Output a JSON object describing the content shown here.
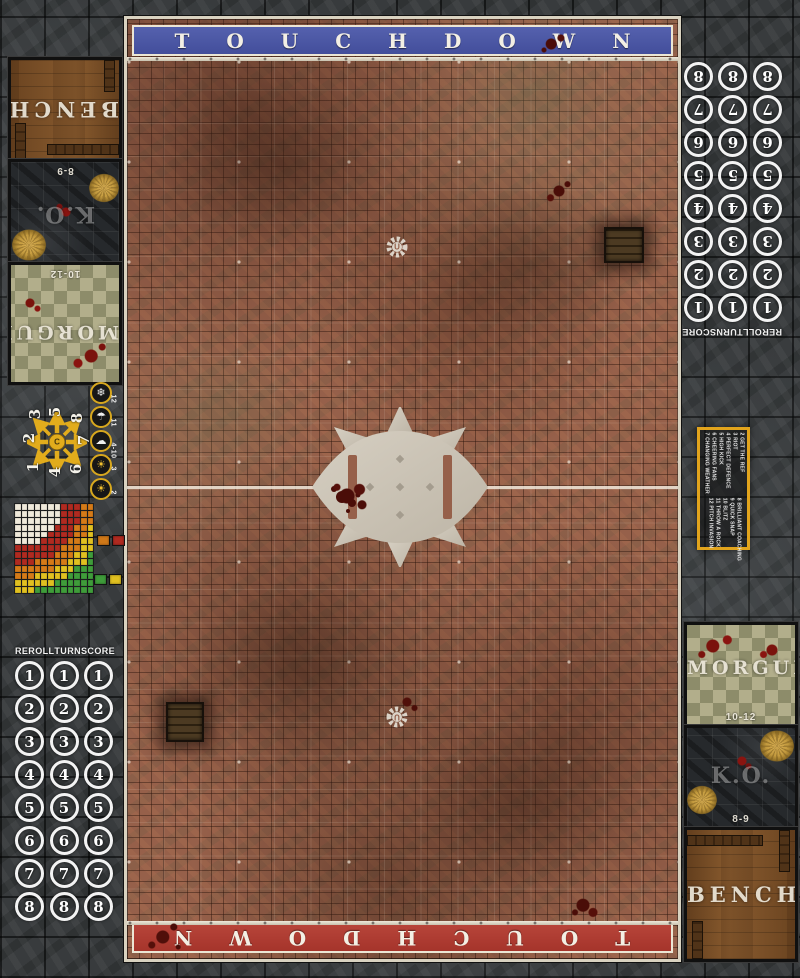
{
  "banners": {
    "top": "TOUCHDOWN",
    "bottom": "TOUCHDOWN",
    "top_color": "#4a55a3",
    "bottom_color": "#b23a2e"
  },
  "dugout_labels": {
    "bench": "BENCH",
    "ko": "K.O.",
    "ko_range": "8-9",
    "morgue": "MORGUE",
    "morgue_range": "10-12"
  },
  "turn_track": {
    "headers": [
      "REROLL",
      "TURN",
      "SCORE"
    ],
    "turns": [
      "1",
      "2",
      "3",
      "4",
      "5",
      "6",
      "7",
      "8"
    ]
  },
  "weather_track": {
    "items": [
      {
        "range": "12",
        "icon": "blizzard-icon",
        "glyph": "❄"
      },
      {
        "range": "11",
        "icon": "rain-icon",
        "glyph": "☂"
      },
      {
        "range": "4-10",
        "icon": "partly-cloudy-icon",
        "glyph": "☁"
      },
      {
        "range": "3",
        "icon": "sunny-icon",
        "glyph": "☀"
      },
      {
        "range": "2",
        "icon": "sweltering-sun-icon",
        "glyph": "☀"
      }
    ]
  },
  "scatter_template": {
    "center_glyph": "C",
    "numbers": [
      {
        "n": "3",
        "x": 35,
        "y": 414
      },
      {
        "n": "5",
        "x": 55,
        "y": 412
      },
      {
        "n": "8",
        "x": 77,
        "y": 418
      },
      {
        "n": "2",
        "x": 29,
        "y": 438
      },
      {
        "n": "7",
        "x": 84,
        "y": 440
      },
      {
        "n": "1",
        "x": 33,
        "y": 467
      },
      {
        "n": "4",
        "x": 55,
        "y": 472
      },
      {
        "n": "6",
        "x": 76,
        "y": 469
      }
    ]
  },
  "kickoff_table": {
    "entries": [
      "2 GET THE REF",
      "3 RIOT",
      "4 PERFECT DEFENCE",
      "5 HIGH KICK",
      "6 CHEERING FANS",
      "7 CHANGING WEATHER",
      "8 BRILLIANT COACHING",
      "9 QUICK SNAP",
      "10 BLITZ",
      "11 THROW A ROCK",
      "12 PITCH INVASION"
    ]
  },
  "range_ruler": {
    "cols": 12,
    "rows": 13,
    "bands": [
      {
        "name": "quick-pass",
        "color": "#efe9da",
        "max": 0.55
      },
      {
        "name": "short-pass",
        "color": "#b02a20",
        "max": 0.78
      },
      {
        "name": "long-pass",
        "color": "#d47a18",
        "max": 0.94
      },
      {
        "name": "long-bomb",
        "color": "#e0c020",
        "max": 1.1
      },
      {
        "name": "out-of-range",
        "color": "#3f9c3a",
        "max": 9
      }
    ]
  },
  "chips": [
    {
      "color": "#d07818"
    },
    {
      "color": "#b02a20"
    },
    {
      "color": "#3f9c3a"
    },
    {
      "color": "#e0c020"
    }
  ]
}
